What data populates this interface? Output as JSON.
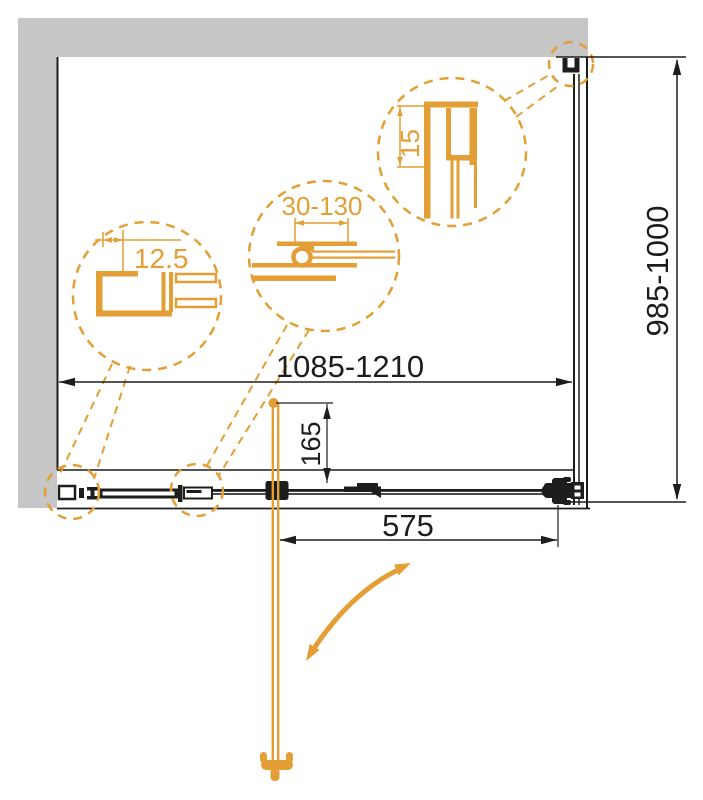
{
  "drawing": {
    "title_hidden": "",
    "dim_width": "1085-1210",
    "dim_height": "985-1000",
    "dim_door": "575",
    "dim_handle_offset": "165",
    "detail_glass": "12.5",
    "detail_adjust": "30-130",
    "detail_profile": "15"
  },
  "colors": {
    "accent_orange": "#E39F35",
    "wall_gray": "#C6C6C6",
    "line_black": "#1D1D1B",
    "background": "#FFFFFF"
  },
  "icons": {
    "swing_arrow": "curved-double-arrow",
    "door_handle": "knob-handle-plan-view"
  }
}
